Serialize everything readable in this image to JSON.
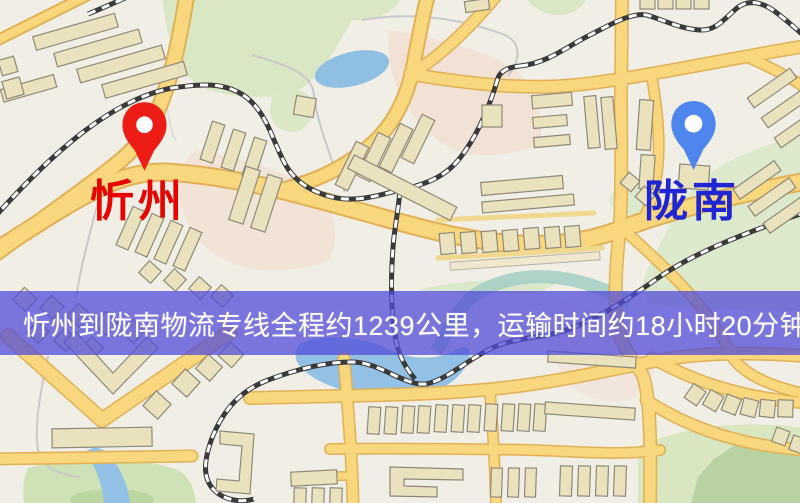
{
  "type": "logistics-route-map",
  "origin": {
    "name": "忻州",
    "pin_color": "#ed1d16",
    "label_color": "#e60400"
  },
  "destination": {
    "name": "陇南",
    "pin_color": "#4f86ee",
    "label_color": "#2026d2"
  },
  "banner": {
    "text": "忻州到陇南物流专线全程约1239公里，运输时间约18小时20分钟.",
    "background_color": "#524cd8",
    "opacity": 0.75,
    "text_color": "#ffffff"
  },
  "route": {
    "distance_km": 1239,
    "duration": "18小时20分钟"
  },
  "map_style": {
    "background": "#f1eee6",
    "road_color": "#f8d77e",
    "road_casing": "#e0b156",
    "railway_color": "#3a3a3a",
    "water_color": "#93c1e6",
    "park_color": "#d9e7c4",
    "building_color": "#eae1bd"
  }
}
